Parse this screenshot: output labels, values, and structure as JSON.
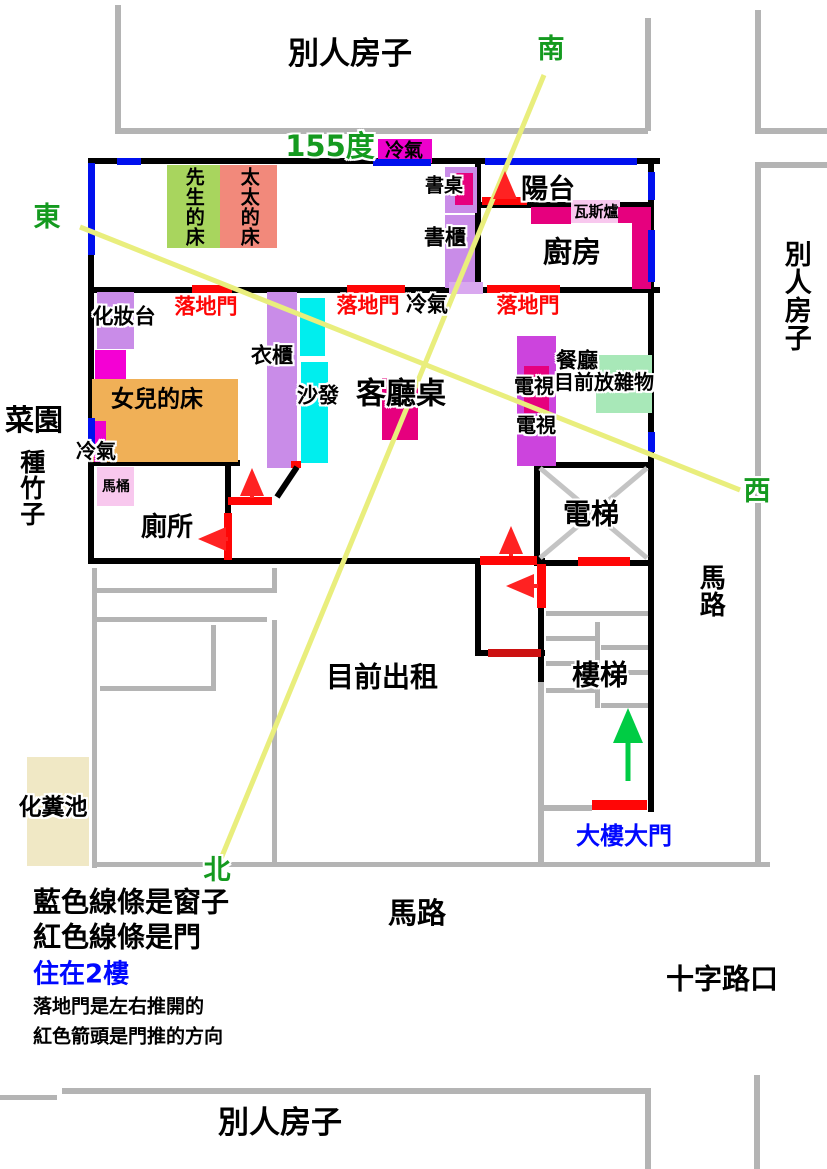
{
  "labels": {
    "neighbor_top": "別人房子",
    "neighbor_right": "別人房子",
    "neighbor_bottom": "別人房子",
    "south": "南",
    "east": "東",
    "west": "西",
    "north": "北",
    "angle": "155度",
    "ac_top": "冷氣",
    "ac_mid": "冷氣",
    "ac_left": "冷氣",
    "husband_bed": "先生的床",
    "wife_bed": "太太的床",
    "desk": "書桌",
    "bookcase": "書櫃",
    "balcony": "陽台",
    "gas_stove": "瓦斯爐",
    "kitchen": "廚房",
    "vanity": "化妝台",
    "sliding_door_1": "落地門",
    "sliding_door_2": "落地門",
    "sliding_door_3": "落地門",
    "wardrobe": "衣櫃",
    "sofa": "沙發",
    "living_table": "客廳桌",
    "tv_1": "電視",
    "tv_2": "電視",
    "dining": "餐廳",
    "dining_note": "目前放雜物",
    "garden": "菜園",
    "bamboo": "種竹子",
    "daughter_bed": "女兒的床",
    "toilet_bowl": "馬桶",
    "toilet_room": "廁所",
    "elevator": "電梯",
    "stairs": "樓梯",
    "for_rent": "目前出租",
    "septic_tank": "化糞池",
    "main_gate": "大樓大門",
    "road_right": "馬路",
    "road_bottom": "馬路",
    "crossroad": "十字路口",
    "legend_blue_line": "藍色線條是窗子",
    "legend_red_line": "紅色線條是門",
    "legend_floor": "住在2樓",
    "legend_sliding": "落地門是左右推開的",
    "legend_arrow": "紅色箭頭是門推的方向"
  },
  "colors": {
    "wall_black": "#000000",
    "neighbor_gray": "#b4b4b4",
    "window_blue": "#0010ee",
    "door_red": "#ff0606",
    "door_dark_red": "#cc1111",
    "compass_green": "#149a1f",
    "sight_line_yellow": "#e9ee7d",
    "bed_green": "#a8d55e",
    "bed_salmon": "#f2897b",
    "bed_orange": "#f0b057",
    "furniture_purple": "#c98ce8",
    "magenta_ac": "#ee00cc",
    "deep_pink": "#e6007e",
    "tv_purple": "#cc44dd",
    "sofa_cyan": "#00eeee",
    "dining_green": "#a8e8b8",
    "light_pink": "#f8c8ee",
    "septic_beige": "#f0e8c5",
    "gate_text_blue": "#0008ff",
    "stair_arrow_green": "#00cc44"
  }
}
